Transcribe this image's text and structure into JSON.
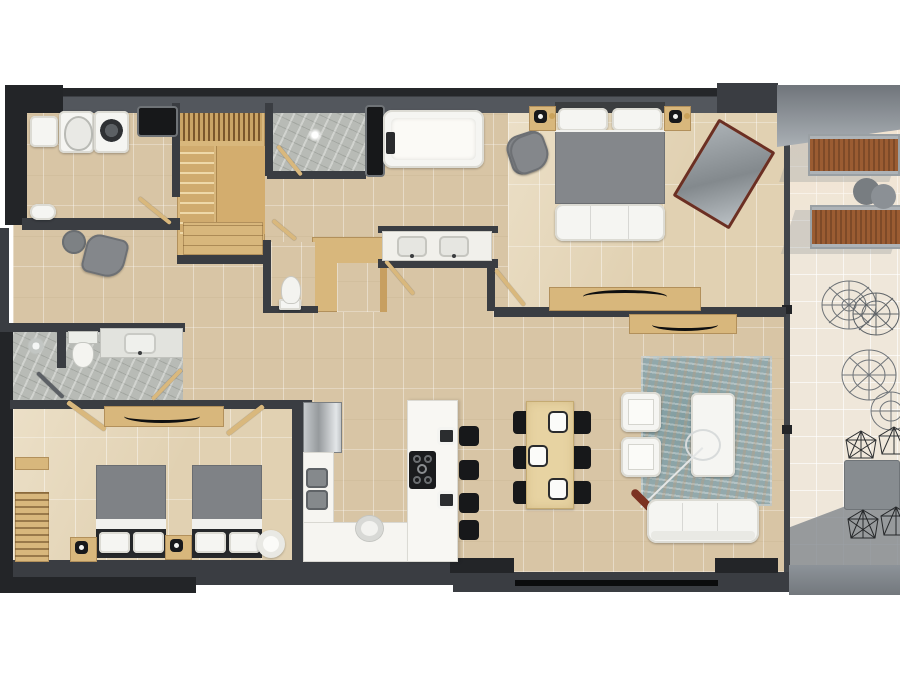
{
  "meta": {
    "title": "Apartment floor plan",
    "description": "Top-down 3D rendered floor plan of a two-bedroom apartment with balcony",
    "view": "top-down render, no visible text labels"
  },
  "palette": {
    "wall_dark": "#3a3d42",
    "wall_black": "#232528",
    "wall_gray": "#53575d",
    "floor_tile": "#d8c5a5",
    "floor_bedroom": "#e1d1b2",
    "floor_marble": "#b8bbb6",
    "floor_balcony": "#efe7da",
    "wood": "#d8b77c",
    "white_furniture": "#f5f5f2",
    "gray_furniture": "#84878b",
    "black_furniture": "#17181a",
    "rug_teal": "#93a9ac",
    "lounger_brown": "#95582e",
    "mirror_frame": "#6b2f23"
  },
  "rooms": [
    {
      "label": "Laundry / utility room",
      "items": [
        "wall basin",
        "toilet",
        "washing machine",
        "counter niche",
        "wall shelf with dish"
      ]
    },
    {
      "label": "Staircase",
      "items": [
        "wood stairs",
        "balustrade",
        "under-stair cabinet"
      ]
    },
    {
      "label": "Shower room",
      "items": [
        "marble floor",
        "shower drain",
        "glass door"
      ]
    },
    {
      "label": "Master bathroom",
      "items": [
        "freestanding bathtub",
        "bath tray",
        "double-sink vanity",
        "storage niche",
        "armchair"
      ]
    },
    {
      "label": "Master bedroom",
      "items": [
        "double bed",
        "two nightstands with lamps",
        "bench at foot of bed",
        "armchair",
        "leaning mirror",
        "TV console with curved TV"
      ]
    },
    {
      "label": "Powder room",
      "items": [
        "toilet"
      ]
    },
    {
      "label": "Walk-in closet",
      "items": [
        "L-shaped wardrobe"
      ]
    },
    {
      "label": "Hallway / entry",
      "items": [
        "round side table",
        "armchair",
        "wall shelf"
      ]
    },
    {
      "label": "Second bathroom",
      "items": [
        "walk-in shower",
        "toilet",
        "vanity with sink"
      ]
    },
    {
      "label": "Second bedroom",
      "items": [
        "two single beds",
        "two nightstands with lamps",
        "round pouf",
        "TV console with curved TV",
        "slatted wardrobe",
        "shelf"
      ]
    },
    {
      "label": "Kitchen",
      "items": [
        "refrigerator",
        "double sink",
        "L-counter",
        "island with gas cooktop",
        "four black stools",
        "two white-frame chairs",
        "pot"
      ]
    },
    {
      "label": "Dining area",
      "items": [
        "wood dining table",
        "six black chairs",
        "three place settings"
      ]
    },
    {
      "label": "Living area",
      "items": [
        "teal area rug",
        "three-seat white sofa",
        "two white armchairs",
        "white coffee table",
        "arc floor lamp",
        "TV console with curved TV"
      ]
    },
    {
      "label": "Balcony",
      "items": [
        "two wooden sun loungers",
        "two round side tables",
        "wire lounge chairs",
        "outdoor dining table",
        "wire dining chairs",
        "glass wall"
      ]
    }
  ]
}
